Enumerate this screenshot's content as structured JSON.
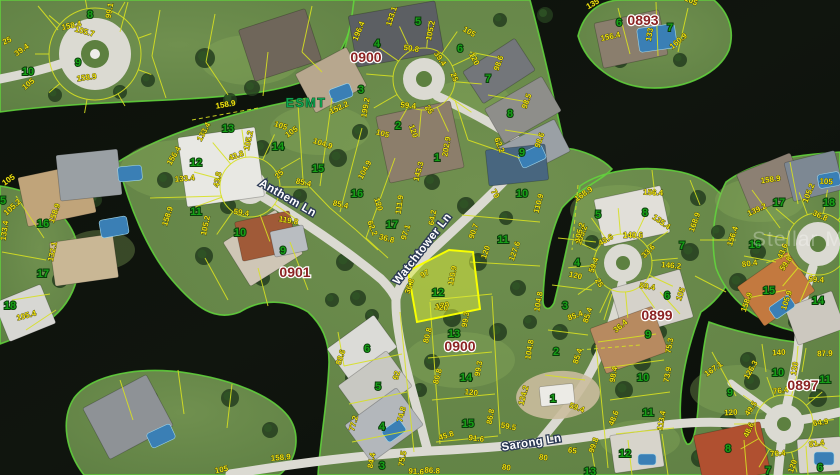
{
  "map": {
    "type": "satellite-parcel-map",
    "watermark": "Stellar MLS",
    "easement_label": "ESMT",
    "selected_parcel": {
      "lot": "12",
      "block": "0900"
    },
    "colors": {
      "water": "#0d120c",
      "land": "#66874a",
      "shoreline": "#62d83c",
      "road": "#dbdad2",
      "parcel_line": "#d7e021",
      "dimension_text": "#f0e312",
      "lot_number_text": "#17a017",
      "street_text": "#ffffff",
      "block_text": "#8b2323",
      "easement_text": "#0fa352",
      "selected_fill": "#dff03c",
      "selected_border": "#f8ff00"
    },
    "streets": [
      {
        "name": "Anthem Ln"
      },
      {
        "name": "Watchtower Ln"
      },
      {
        "name": "Sarong Ln"
      }
    ],
    "blocks": [
      {
        "id": "0900"
      },
      {
        "id": "0893"
      },
      {
        "id": "0901"
      },
      {
        "id": "0899"
      },
      {
        "id": "0900"
      },
      {
        "id": "0897"
      }
    ],
    "lots": [
      {
        "n": "8",
        "x": 90,
        "y": 14
      },
      {
        "n": "9",
        "x": 78,
        "y": 62
      },
      {
        "n": "10",
        "x": 28,
        "y": 71
      },
      {
        "n": "5",
        "x": 3,
        "y": 200
      },
      {
        "n": "16",
        "x": 43,
        "y": 223
      },
      {
        "n": "17",
        "x": 43,
        "y": 273
      },
      {
        "n": "18",
        "x": 10,
        "y": 305
      },
      {
        "n": "13",
        "x": 228,
        "y": 128
      },
      {
        "n": "14",
        "x": 278,
        "y": 146
      },
      {
        "n": "12",
        "x": 196,
        "y": 162
      },
      {
        "n": "15",
        "x": 318,
        "y": 168
      },
      {
        "n": "16",
        "x": 357,
        "y": 193
      },
      {
        "n": "11",
        "x": 196,
        "y": 211
      },
      {
        "n": "10",
        "x": 240,
        "y": 232
      },
      {
        "n": "17",
        "x": 392,
        "y": 224
      },
      {
        "n": "9",
        "x": 283,
        "y": 250
      },
      {
        "n": "5",
        "x": 418,
        "y": 21
      },
      {
        "n": "4",
        "x": 377,
        "y": 43
      },
      {
        "n": "6",
        "x": 460,
        "y": 48
      },
      {
        "n": "3",
        "x": 361,
        "y": 89
      },
      {
        "n": "2",
        "x": 398,
        "y": 125
      },
      {
        "n": "1",
        "x": 437,
        "y": 157
      },
      {
        "n": "7",
        "x": 488,
        "y": 78
      },
      {
        "n": "8",
        "x": 510,
        "y": 113
      },
      {
        "n": "9",
        "x": 522,
        "y": 152
      },
      {
        "n": "10",
        "x": 522,
        "y": 193
      },
      {
        "n": "11",
        "x": 503,
        "y": 239
      },
      {
        "n": "12",
        "x": 438,
        "y": 292
      },
      {
        "n": "4",
        "x": 577,
        "y": 262
      },
      {
        "n": "3",
        "x": 565,
        "y": 305
      },
      {
        "n": "2",
        "x": 556,
        "y": 351
      },
      {
        "n": "1",
        "x": 553,
        "y": 398
      },
      {
        "n": "13",
        "x": 454,
        "y": 333
      },
      {
        "n": "14",
        "x": 466,
        "y": 377
      },
      {
        "n": "15",
        "x": 468,
        "y": 423
      },
      {
        "n": "6",
        "x": 367,
        "y": 348
      },
      {
        "n": "5",
        "x": 378,
        "y": 386
      },
      {
        "n": "4",
        "x": 382,
        "y": 426
      },
      {
        "n": "3",
        "x": 382,
        "y": 465
      },
      {
        "n": "5",
        "x": 598,
        "y": 214
      },
      {
        "n": "8",
        "x": 645,
        "y": 212
      },
      {
        "n": "7",
        "x": 682,
        "y": 245
      },
      {
        "n": "6",
        "x": 667,
        "y": 295
      },
      {
        "n": "9",
        "x": 648,
        "y": 334
      },
      {
        "n": "10",
        "x": 643,
        "y": 377
      },
      {
        "n": "11",
        "x": 648,
        "y": 412
      },
      {
        "n": "12",
        "x": 625,
        "y": 453
      },
      {
        "n": "13",
        "x": 590,
        "y": 471
      },
      {
        "n": "9",
        "x": 730,
        "y": 392
      },
      {
        "n": "10",
        "x": 778,
        "y": 372
      },
      {
        "n": "11",
        "x": 825,
        "y": 379
      },
      {
        "n": "8",
        "x": 728,
        "y": 448
      },
      {
        "n": "7",
        "x": 768,
        "y": 470
      },
      {
        "n": "6",
        "x": 820,
        "y": 467
      },
      {
        "n": "6",
        "x": 619,
        "y": 22
      },
      {
        "n": "7",
        "x": 670,
        "y": 27
      },
      {
        "n": "17",
        "x": 779,
        "y": 202
      },
      {
        "n": "18",
        "x": 829,
        "y": 202
      },
      {
        "n": "16",
        "x": 755,
        "y": 244
      },
      {
        "n": "15",
        "x": 769,
        "y": 290
      },
      {
        "n": "14",
        "x": 818,
        "y": 300
      }
    ],
    "dims": [
      {
        "t": "25",
        "x": 8,
        "y": 43,
        "r": -25
      },
      {
        "t": "39.4",
        "x": 23,
        "y": 52,
        "r": -35
      },
      {
        "t": "105",
        "x": 30,
        "y": 86,
        "r": -40
      },
      {
        "t": "99.1",
        "x": 112,
        "y": 11,
        "r": -80
      },
      {
        "t": "158.4",
        "x": 72,
        "y": 28,
        "r": -12
      },
      {
        "t": "105.7",
        "x": 84,
        "y": 34,
        "r": 15
      },
      {
        "t": "158.9",
        "x": 87,
        "y": 80,
        "r": -8
      },
      {
        "t": "105",
        "x": 10,
        "y": 182,
        "r": -35
      },
      {
        "t": "105.2",
        "x": 14,
        "y": 209,
        "r": -42
      },
      {
        "t": "158.9",
        "x": 57,
        "y": 214,
        "r": -70
      },
      {
        "t": "132.1",
        "x": 55,
        "y": 252,
        "r": -78
      },
      {
        "t": "133.4",
        "x": 7,
        "y": 231,
        "r": -82
      },
      {
        "t": "105.4",
        "x": 27,
        "y": 318,
        "r": -15
      },
      {
        "t": "158.9",
        "x": 226,
        "y": 107,
        "r": -10
      },
      {
        "t": "133.4",
        "x": 206,
        "y": 133,
        "r": -62
      },
      {
        "t": "105.2",
        "x": 251,
        "y": 141,
        "r": -78
      },
      {
        "t": "105",
        "x": 280,
        "y": 128,
        "r": 18
      },
      {
        "t": "156.4",
        "x": 176,
        "y": 157,
        "r": -60
      },
      {
        "t": "43.8",
        "x": 237,
        "y": 158,
        "r": -20
      },
      {
        "t": "104.9",
        "x": 322,
        "y": 146,
        "r": 18
      },
      {
        "t": "133.4",
        "x": 185,
        "y": 181,
        "r": -5
      },
      {
        "t": "43.8",
        "x": 220,
        "y": 180,
        "r": -80
      },
      {
        "t": "25",
        "x": 281,
        "y": 176,
        "r": -45
      },
      {
        "t": "85.4",
        "x": 303,
        "y": 185,
        "r": 12
      },
      {
        "t": "104.9",
        "x": 367,
        "y": 171,
        "r": -62
      },
      {
        "t": "120",
        "x": 376,
        "y": 205,
        "r": 72
      },
      {
        "t": "85.4",
        "x": 340,
        "y": 207,
        "r": 12
      },
      {
        "t": "158.9",
        "x": 170,
        "y": 217,
        "r": -72
      },
      {
        "t": "105.2",
        "x": 208,
        "y": 226,
        "r": -78
      },
      {
        "t": "59.4",
        "x": 241,
        "y": 215,
        "r": 8
      },
      {
        "t": "119.8",
        "x": 288,
        "y": 223,
        "r": 10
      },
      {
        "t": "111.9",
        "x": 402,
        "y": 205,
        "r": -82
      },
      {
        "t": "64.2",
        "x": 435,
        "y": 218,
        "r": -80
      },
      {
        "t": "97.1",
        "x": 408,
        "y": 233,
        "r": -72
      },
      {
        "t": "62.2",
        "x": 370,
        "y": 229,
        "r": 68
      },
      {
        "t": "36.8",
        "x": 386,
        "y": 241,
        "r": 15
      },
      {
        "t": "143.3",
        "x": 421,
        "y": 172,
        "r": -75
      },
      {
        "t": "152.2",
        "x": 340,
        "y": 110,
        "r": -25
      },
      {
        "t": "105",
        "x": 293,
        "y": 134,
        "r": -35
      },
      {
        "t": "97",
        "x": 426,
        "y": 276,
        "r": -30
      },
      {
        "t": "36.8",
        "x": 412,
        "y": 287,
        "r": -72
      },
      {
        "t": "110.9",
        "x": 455,
        "y": 276,
        "r": -78
      },
      {
        "t": "120",
        "x": 443,
        "y": 308,
        "r": -10
      },
      {
        "t": "196.4",
        "x": 361,
        "y": 32,
        "r": -68
      },
      {
        "t": "133.1",
        "x": 394,
        "y": 17,
        "r": -72
      },
      {
        "t": "105.2",
        "x": 433,
        "y": 31,
        "r": -78
      },
      {
        "t": "50.8",
        "x": 411,
        "y": 51,
        "r": 8
      },
      {
        "t": "39.4",
        "x": 438,
        "y": 60,
        "r": 55
      },
      {
        "t": "25",
        "x": 452,
        "y": 78,
        "r": 68
      },
      {
        "t": "105",
        "x": 468,
        "y": 34,
        "r": 30
      },
      {
        "t": "120",
        "x": 472,
        "y": 60,
        "r": 62
      },
      {
        "t": "98.6",
        "x": 501,
        "y": 64,
        "r": -70
      },
      {
        "t": "98.5",
        "x": 529,
        "y": 102,
        "r": -70
      },
      {
        "t": "98.6",
        "x": 542,
        "y": 141,
        "r": -70
      },
      {
        "t": "62.2",
        "x": 497,
        "y": 146,
        "r": 68
      },
      {
        "t": "199.2",
        "x": 368,
        "y": 108,
        "r": -80
      },
      {
        "t": "59.4",
        "x": 408,
        "y": 108,
        "r": 5
      },
      {
        "t": "25",
        "x": 427,
        "y": 111,
        "r": 55
      },
      {
        "t": "105",
        "x": 382,
        "y": 136,
        "r": 15
      },
      {
        "t": "120",
        "x": 411,
        "y": 132,
        "r": 70
      },
      {
        "t": "202.9",
        "x": 449,
        "y": 147,
        "r": -80
      },
      {
        "t": "70",
        "x": 493,
        "y": 195,
        "r": 60
      },
      {
        "t": "110.9",
        "x": 541,
        "y": 204,
        "r": -75
      },
      {
        "t": "90.7",
        "x": 476,
        "y": 232,
        "r": -70
      },
      {
        "t": "120",
        "x": 488,
        "y": 253,
        "r": -70
      },
      {
        "t": "127.6",
        "x": 517,
        "y": 252,
        "r": -70
      },
      {
        "t": "105.2",
        "x": 584,
        "y": 236,
        "r": -70
      },
      {
        "t": "59.4",
        "x": 596,
        "y": 266,
        "r": -70
      },
      {
        "t": "120",
        "x": 575,
        "y": 278,
        "r": 12
      },
      {
        "t": "25",
        "x": 597,
        "y": 284,
        "r": 60
      },
      {
        "t": "104.8",
        "x": 541,
        "y": 302,
        "r": -80
      },
      {
        "t": "85.4",
        "x": 590,
        "y": 316,
        "r": -72
      },
      {
        "t": "104.8",
        "x": 532,
        "y": 350,
        "r": -80
      },
      {
        "t": "85.4",
        "x": 580,
        "y": 357,
        "r": -72
      },
      {
        "t": "124.2",
        "x": 526,
        "y": 396,
        "r": -75
      },
      {
        "t": "59.4",
        "x": 576,
        "y": 410,
        "r": 20
      },
      {
        "t": "59.5",
        "x": 508,
        "y": 429,
        "r": 10
      },
      {
        "t": "120",
        "x": 441,
        "y": 310,
        "r": 8
      },
      {
        "t": "99.3",
        "x": 468,
        "y": 320,
        "r": -80
      },
      {
        "t": "80.8",
        "x": 430,
        "y": 336,
        "r": -75
      },
      {
        "t": "99.3",
        "x": 481,
        "y": 369,
        "r": -80
      },
      {
        "t": "80.8",
        "x": 440,
        "y": 377,
        "r": -75
      },
      {
        "t": "120",
        "x": 471,
        "y": 395,
        "r": 6
      },
      {
        "t": "86.8",
        "x": 493,
        "y": 417,
        "r": -80
      },
      {
        "t": "45.8",
        "x": 447,
        "y": 438,
        "r": -18
      },
      {
        "t": "91.6",
        "x": 476,
        "y": 441,
        "r": 6
      },
      {
        "t": "88.6",
        "x": 343,
        "y": 358,
        "r": -72
      },
      {
        "t": "92",
        "x": 399,
        "y": 376,
        "r": -75
      },
      {
        "t": "77.2",
        "x": 356,
        "y": 424,
        "r": -75
      },
      {
        "t": "74.8",
        "x": 404,
        "y": 415,
        "r": -75
      },
      {
        "t": "84.4",
        "x": 374,
        "y": 461,
        "r": -80
      },
      {
        "t": "75.5",
        "x": 405,
        "y": 459,
        "r": -80
      },
      {
        "t": "91.6",
        "x": 416,
        "y": 474,
        "r": 4
      },
      {
        "t": "86.8",
        "x": 432,
        "y": 473,
        "r": 4
      },
      {
        "t": "65",
        "x": 572,
        "y": 453,
        "r": 8
      },
      {
        "t": "80",
        "x": 543,
        "y": 460,
        "r": 8
      },
      {
        "t": "80",
        "x": 506,
        "y": 470,
        "r": 8
      },
      {
        "t": "48.6",
        "x": 616,
        "y": 419,
        "r": -68
      },
      {
        "t": "113.4",
        "x": 664,
        "y": 421,
        "r": -80
      },
      {
        "t": "99.8",
        "x": 596,
        "y": 446,
        "r": -70
      },
      {
        "t": "158.9",
        "x": 281,
        "y": 460,
        "r": -5
      },
      {
        "t": "105",
        "x": 222,
        "y": 472,
        "r": -12
      },
      {
        "t": "168.9",
        "x": 585,
        "y": 196,
        "r": -35
      },
      {
        "t": "105.2",
        "x": 582,
        "y": 233,
        "r": -75
      },
      {
        "t": "156.4",
        "x": 653,
        "y": 195,
        "r": 3
      },
      {
        "t": "43.6",
        "x": 607,
        "y": 242,
        "r": -30
      },
      {
        "t": "140.6",
        "x": 633,
        "y": 238,
        "r": 0
      },
      {
        "t": "135.4",
        "x": 660,
        "y": 224,
        "r": 35
      },
      {
        "t": "168.9",
        "x": 697,
        "y": 223,
        "r": -70
      },
      {
        "t": "146.2",
        "x": 671,
        "y": 268,
        "r": 5
      },
      {
        "t": "105",
        "x": 683,
        "y": 295,
        "r": -70
      },
      {
        "t": "59.4",
        "x": 647,
        "y": 289,
        "r": 8
      },
      {
        "t": "33.6",
        "x": 650,
        "y": 253,
        "r": -45
      },
      {
        "t": "85.4",
        "x": 576,
        "y": 318,
        "r": -20
      },
      {
        "t": "36.4",
        "x": 622,
        "y": 328,
        "r": -40
      },
      {
        "t": "75.3",
        "x": 672,
        "y": 346,
        "r": -80
      },
      {
        "t": "73.9",
        "x": 670,
        "y": 375,
        "r": -80
      },
      {
        "t": "98.4",
        "x": 616,
        "y": 375,
        "r": -80
      },
      {
        "t": "167.1",
        "x": 715,
        "y": 371,
        "r": -35
      },
      {
        "t": "126.3",
        "x": 753,
        "y": 371,
        "r": -60
      },
      {
        "t": "140",
        "x": 779,
        "y": 355,
        "r": -3
      },
      {
        "t": "120",
        "x": 797,
        "y": 369,
        "r": -80
      },
      {
        "t": "87.9",
        "x": 825,
        "y": 356,
        "r": -3
      },
      {
        "t": "76.4",
        "x": 781,
        "y": 393,
        "r": -8
      },
      {
        "t": "120",
        "x": 731,
        "y": 415,
        "r": -3
      },
      {
        "t": "49.5",
        "x": 753,
        "y": 410,
        "r": -55
      },
      {
        "t": "48.6",
        "x": 751,
        "y": 431,
        "r": -65
      },
      {
        "t": "64.9",
        "x": 821,
        "y": 425,
        "r": -8
      },
      {
        "t": "76.4",
        "x": 778,
        "y": 456,
        "r": -5
      },
      {
        "t": "81.4",
        "x": 817,
        "y": 446,
        "r": -8
      },
      {
        "t": "120",
        "x": 795,
        "y": 467,
        "r": -70
      },
      {
        "t": "135",
        "x": 594,
        "y": 6,
        "r": -30
      },
      {
        "t": "156.4",
        "x": 611,
        "y": 39,
        "r": -12
      },
      {
        "t": "133",
        "x": 652,
        "y": 35,
        "r": -80
      },
      {
        "t": "160.9",
        "x": 680,
        "y": 43,
        "r": -40
      },
      {
        "t": "105",
        "x": 690,
        "y": 3,
        "r": 25
      },
      {
        "t": "158.9",
        "x": 771,
        "y": 182,
        "r": -8
      },
      {
        "t": "105",
        "x": 826,
        "y": 184,
        "r": 3
      },
      {
        "t": "105.2",
        "x": 811,
        "y": 194,
        "r": -68
      },
      {
        "t": "139.2",
        "x": 758,
        "y": 212,
        "r": -25
      },
      {
        "t": "36.8",
        "x": 819,
        "y": 218,
        "r": 25
      },
      {
        "t": "156.4",
        "x": 735,
        "y": 237,
        "r": -72
      },
      {
        "t": "43.6",
        "x": 785,
        "y": 252,
        "r": -68
      },
      {
        "t": "59.8",
        "x": 788,
        "y": 265,
        "r": -55
      },
      {
        "t": "80.4",
        "x": 750,
        "y": 266,
        "r": -8
      },
      {
        "t": "158.9",
        "x": 749,
        "y": 303,
        "r": -70
      },
      {
        "t": "105.9",
        "x": 789,
        "y": 301,
        "r": -72
      },
      {
        "t": "59.4",
        "x": 816,
        "y": 282,
        "r": 4
      }
    ]
  }
}
